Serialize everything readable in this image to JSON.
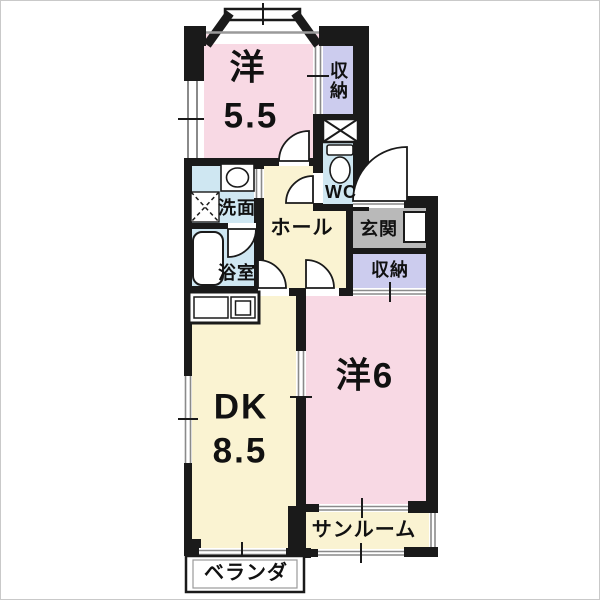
{
  "floorplan": {
    "rooms": {
      "western_55": {
        "name_label": "洋",
        "size_label": "5.5"
      },
      "closet_north": {
        "label": "収納"
      },
      "wc": {
        "label": "WC"
      },
      "washroom": {
        "label": "洗面"
      },
      "bathroom": {
        "label": "浴室"
      },
      "hall": {
        "label": "ホール"
      },
      "entrance": {
        "label": "玄関"
      },
      "closet_east": {
        "label": "収納"
      },
      "western_6": {
        "label": "洋6"
      },
      "dining_kitchen": {
        "name_label": "DK",
        "size_label": "8.5"
      },
      "sunroom": {
        "label": "サンルーム"
      },
      "veranda": {
        "label": "ベランダ"
      }
    },
    "colors": {
      "room_pink": "#f8d9e4",
      "room_cream": "#faf3d2",
      "wet_area_blue": "#cfe7f2",
      "closet_purple": "#ccccee",
      "entrance_gray": "#b9b9b9",
      "wall_black": "#1a1a1a",
      "window_gray": "#8a8a8a"
    }
  }
}
